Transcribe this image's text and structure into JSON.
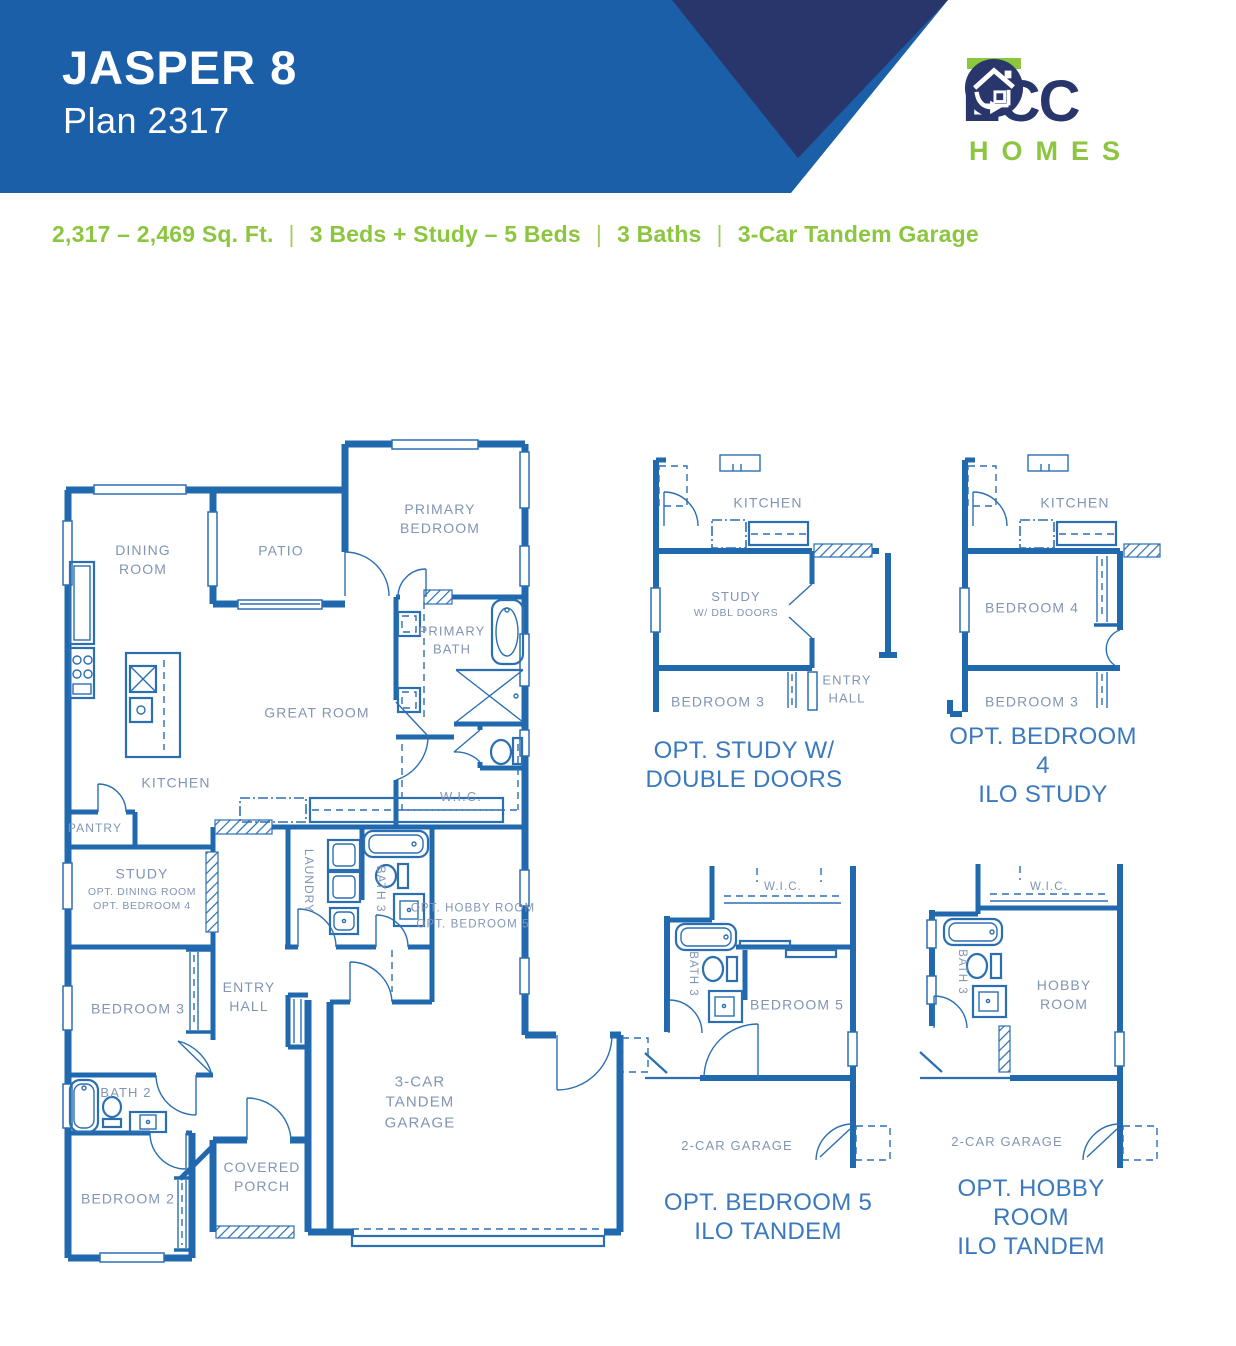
{
  "header": {
    "title": "JASPER 8",
    "subtitle": "Plan 2317"
  },
  "logo": {
    "brand": "ECC",
    "brand_icon": "house-in-circle",
    "word": "HOMES"
  },
  "specs": {
    "separator": "|",
    "items": [
      "2,317 – 2,469 Sq. Ft.",
      "3 Beds + Study – 5 Beds",
      "3 Baths",
      "3-Car Tandem Garage"
    ]
  },
  "main_plan": {
    "rooms": [
      {
        "id": "dining-room",
        "text": "DINING\nROOM"
      },
      {
        "id": "patio",
        "text": "PATIO"
      },
      {
        "id": "primary-bedroom",
        "text": "PRIMARY\nBEDROOM"
      },
      {
        "id": "primary-bath",
        "text": "PRIMARY\nBATH"
      },
      {
        "id": "great-room",
        "text": "GREAT ROOM"
      },
      {
        "id": "kitchen",
        "text": "KITCHEN"
      },
      {
        "id": "pantry",
        "text": "PANTRY"
      },
      {
        "id": "wic",
        "text": "W.I.C."
      },
      {
        "id": "study",
        "text": "STUDY",
        "sub": "OPT. DINING ROOM\nOPT. BEDROOM 4"
      },
      {
        "id": "laundry",
        "text": "LAUNDRY"
      },
      {
        "id": "bath-3",
        "text": "BATH 3"
      },
      {
        "id": "opt-hobby",
        "text": "OPT. HOBBY ROOM\nOPT. BEDROOM 5"
      },
      {
        "id": "entry-hall",
        "text": "ENTRY\nHALL"
      },
      {
        "id": "bedroom-3",
        "text": "BEDROOM 3"
      },
      {
        "id": "bath-2",
        "text": "BATH 2"
      },
      {
        "id": "bedroom-2",
        "text": "BEDROOM 2"
      },
      {
        "id": "covered-porch",
        "text": "COVERED\nPORCH"
      },
      {
        "id": "garage",
        "text": "3-CAR\nTANDEM\nGARAGE"
      }
    ]
  },
  "options": [
    {
      "caption": "OPT. STUDY W/\nDOUBLE DOORS",
      "rooms": [
        {
          "text": "KITCHEN"
        },
        {
          "text": "STUDY",
          "sub": "W/ DBL DOORS"
        },
        {
          "text": "BEDROOM 3"
        },
        {
          "text": "ENTRY\nHALL"
        }
      ]
    },
    {
      "caption": "OPT. BEDROOM 4\nILO STUDY",
      "rooms": [
        {
          "text": "KITCHEN"
        },
        {
          "text": "BEDROOM 4"
        },
        {
          "text": "BEDROOM 3"
        }
      ]
    },
    {
      "caption": "OPT. BEDROOM 5\nILO TANDEM",
      "rooms": [
        {
          "text": "W.I.C."
        },
        {
          "text": "BATH 3"
        },
        {
          "text": "BEDROOM 5"
        },
        {
          "text": "2-CAR GARAGE"
        }
      ]
    },
    {
      "caption": "OPT. HOBBY ROOM\nILO TANDEM",
      "rooms": [
        {
          "text": "W.I.C."
        },
        {
          "text": "BATH 3"
        },
        {
          "text": "HOBBY\nROOM"
        },
        {
          "text": "2-CAR GARAGE"
        }
      ]
    }
  ],
  "colors": {
    "banner_blue": "#1c5fa9",
    "triangle_navy": "#28366b",
    "logo_navy": "#28366b",
    "accent_green": "#8cc63f",
    "wall_blue": "#2169ae",
    "room_label": "#8195b4",
    "caption_blue": "#3a79bd"
  }
}
